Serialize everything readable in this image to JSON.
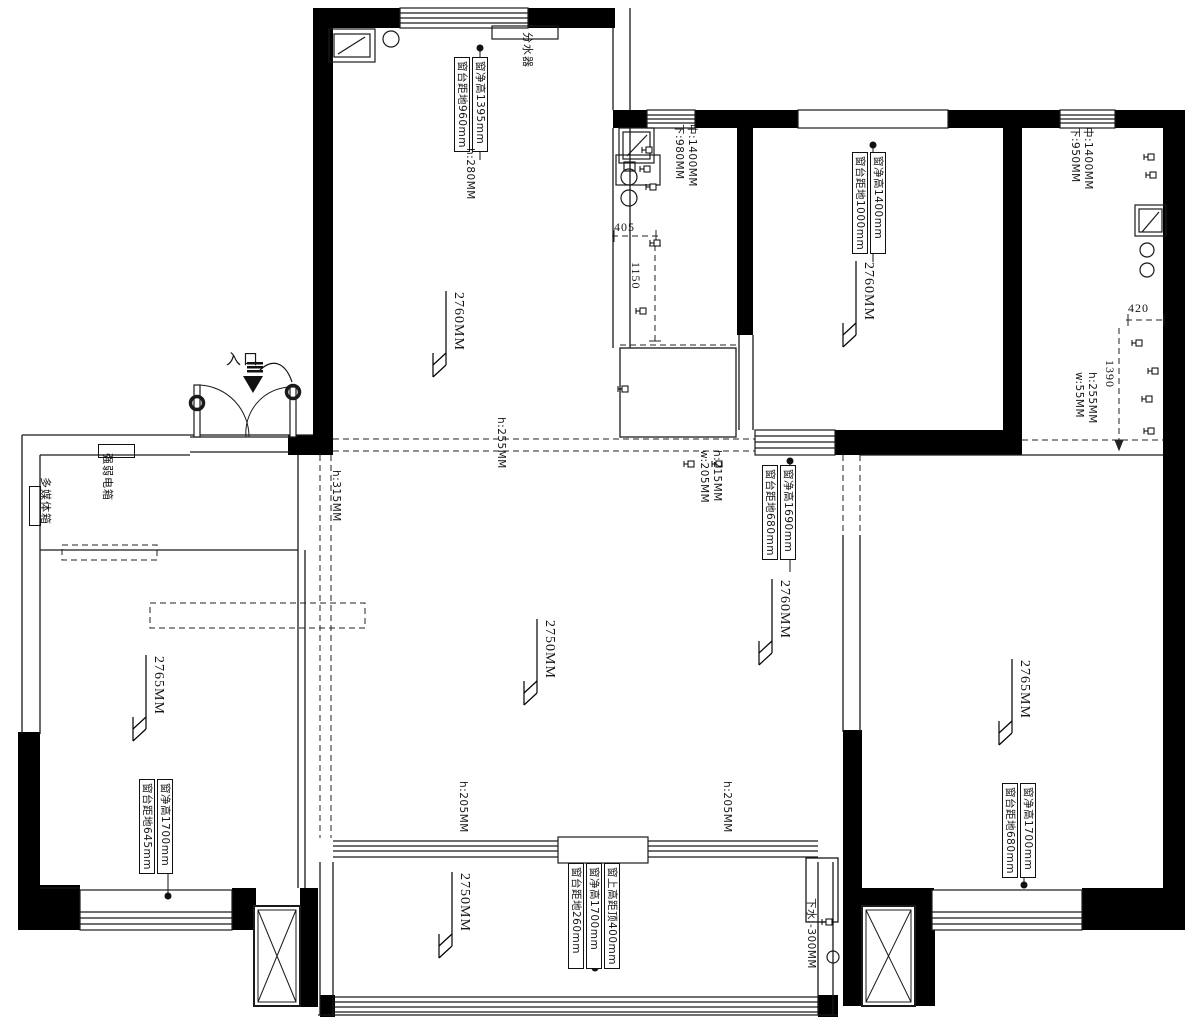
{
  "drawing": {
    "type": "floor-plan",
    "colors": {
      "wall": "#000000",
      "line": "#1a1a1a",
      "background": "#ffffff"
    }
  },
  "rooms": {
    "kitchen": {
      "height_label": "2760MM"
    },
    "bedroom_top": {
      "height_label": "2760MM"
    },
    "dining": {
      "height_label": "2760MM"
    },
    "living": {
      "height_label": "2750MM"
    },
    "bedroom_left": {
      "height_label": "2765MM"
    },
    "bedroom_right": {
      "height_label": "2765MM"
    },
    "balcony": {
      "height_label": "2750MM"
    }
  },
  "window_annotations": {
    "kitchen": [
      "窗净高1395mm",
      "窗台距地960mm"
    ],
    "bedroom_top": [
      "窗净高1400mm",
      "窗台距地1000mm"
    ],
    "dining": [
      "窗净高1690mm",
      "窗台距地680mm"
    ],
    "bedroom_left": [
      "窗净高1700mm",
      "窗台距地645mm"
    ],
    "balcony": [
      "窗上高距顶400mm",
      "窗净高1700mm",
      "窗台距地260mm"
    ],
    "bedroom_right": [
      "窗净高1700mm",
      "窗台距地680mm"
    ]
  },
  "beam_labels": {
    "h280": "h:280MM",
    "h255": "h:255MM",
    "h315": "h:315MM",
    "h215": "h:215MM",
    "w205": "w:205MM",
    "h255b": "h:255MM",
    "w55": "w:55MM",
    "h205_left": "h:205MM",
    "h205_right": "h:205MM"
  },
  "wall_heights": {
    "bath_mid_c": "中:1400MM",
    "bath_mid_b": "下:980MM",
    "bath_right_c": "中:1400MM",
    "bath_right_b": "下:950MM"
  },
  "dimensions": {
    "d405": "405",
    "d1150": "1150",
    "d420": "420",
    "d1390": "1390"
  },
  "equipment": {
    "manifold": "分水器",
    "electric_box": "强弱电箱",
    "media_box": "多媒体箱",
    "drain": "下水:-300MM",
    "entrance": "入口"
  }
}
